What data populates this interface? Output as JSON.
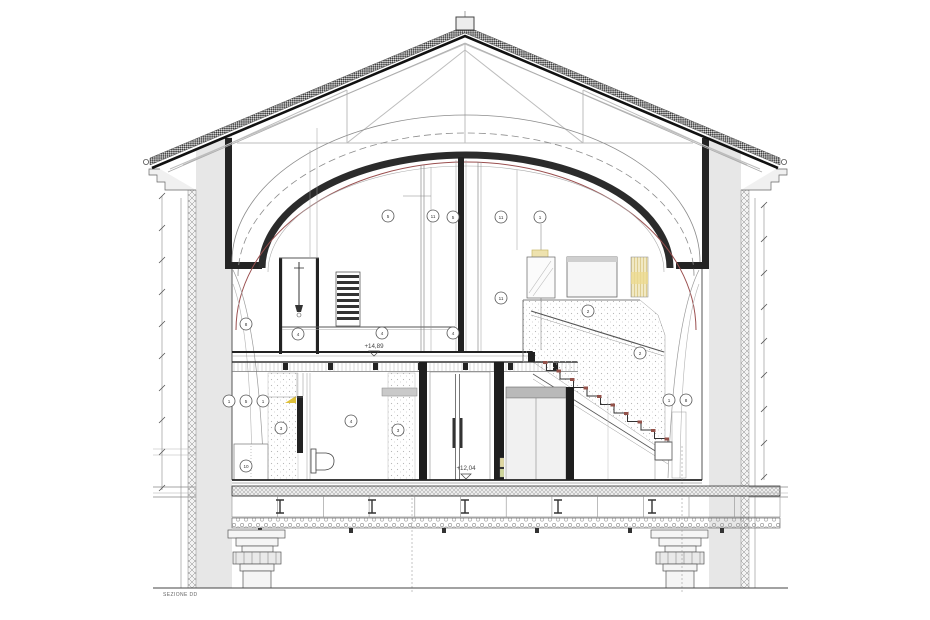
{
  "drawing": {
    "section_label": "SEZIONE DD",
    "levels": {
      "upper": "+14,89",
      "lower": "+12,04"
    },
    "material_tags": [
      "5",
      "11",
      "5",
      "11",
      "1",
      "11",
      "8",
      "4",
      "4",
      "4",
      "2",
      "2",
      "1",
      "5",
      "1",
      "10",
      "1",
      "8",
      "3",
      "4",
      "3"
    ],
    "colors": {
      "structure_dark": "#1e1e1e",
      "wall_gray": "#e7e7e7",
      "vault_red": "#9a4f4f",
      "stair_tread_red": "#94524a",
      "highlight_yellow": "#eee2ae",
      "line_gray": "#888888"
    }
  }
}
